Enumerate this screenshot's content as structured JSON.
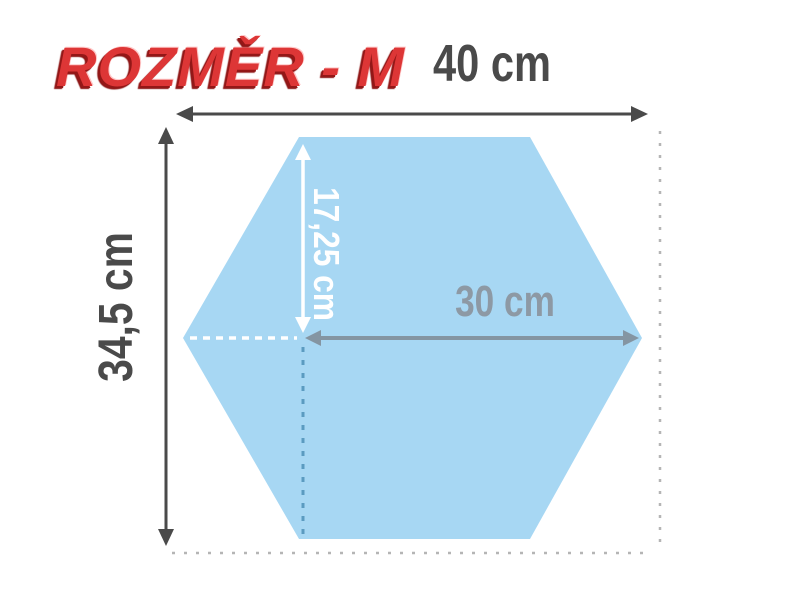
{
  "title": {
    "text": "ROZMĚR - M"
  },
  "labels": {
    "width": "40 cm",
    "height": "34,5 cm",
    "half_height": "17,25 cm",
    "inner_width": "30 cm"
  },
  "colors": {
    "title_red": "#dd3636",
    "hexagon_fill": "#a7d7f3",
    "dim_arrow": "#4a4a4a",
    "label_gray": "#4a4a4a",
    "inner_arrow": "#8495a2",
    "inner_label_gray": "#8d99a4",
    "white_marks": "#ffffff",
    "blue_dash": "#5b9bc0",
    "border_dash": "#b5b5b5"
  }
}
